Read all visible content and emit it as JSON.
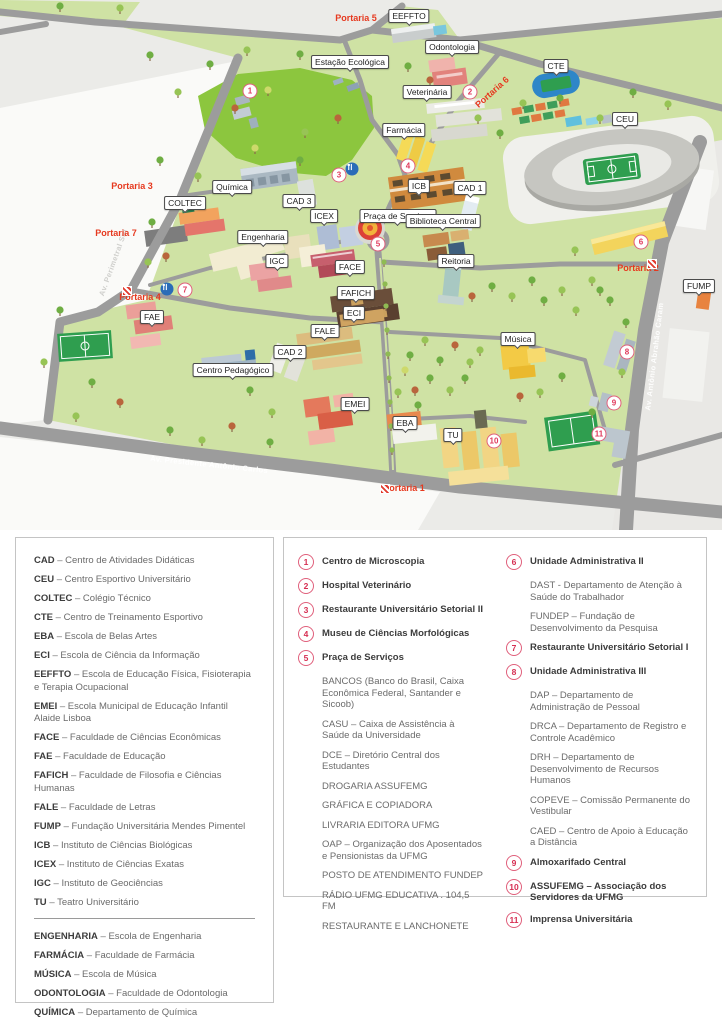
{
  "colors": {
    "campus_green": "#cfe2a4",
    "forest_green": "#8cc63e",
    "road_gray": "#9c9c9c",
    "portaria_red": "#e6391f",
    "marker_pink": "#e23a5f"
  },
  "map": {
    "labels": [
      "EEFFTO",
      "Odontologia",
      "Estação Ecológica",
      "CTE",
      "Veterinária",
      "CEU",
      "Farmácia",
      "Química",
      "ICB",
      "CAD 1",
      "COLTEC",
      "CAD 3",
      "ICEX",
      "Praça de Serviços",
      "Biblioteca Central",
      "Engenharia",
      "IGC",
      "Reitoria",
      "FACE",
      "FUMP",
      "FAFICH",
      "FAE",
      "ECI",
      "FALE",
      "Música",
      "CAD 2",
      "Centro Pedagógico",
      "EMEI",
      "EBA",
      "TU"
    ],
    "portarias": [
      "Portaria 5",
      "Portaria 6",
      "Portaria 3",
      "Portaria 7",
      "Portaria 4",
      "Portaria 2",
      "Portaria 1"
    ],
    "streets": [
      "Av. Perimetral Sul",
      "Av. Presidente Antônio Carlos",
      "Av. Antônio Abrahão Caram"
    ],
    "markers": [
      "1",
      "2",
      "3",
      "4",
      "5",
      "6",
      "7",
      "8",
      "9",
      "10",
      "11"
    ]
  },
  "legend_abbr": {
    "items": [
      {
        "abbr": "CAD",
        "desc": "– Centro de Atividades Didáticas"
      },
      {
        "abbr": "CEU",
        "desc": "– Centro Esportivo Universitário"
      },
      {
        "abbr": "COLTEC",
        "desc": "– Colégio Técnico"
      },
      {
        "abbr": "CTE",
        "desc": "– Centro de Treinamento Esportivo"
      },
      {
        "abbr": "EBA",
        "desc": "– Escola de Belas Artes"
      },
      {
        "abbr": "ECI",
        "desc": "– Escola de Ciência da Informação"
      },
      {
        "abbr": "EEFFTO",
        "desc": "– Escola de Educação Física, Fisioterapia e Terapia Ocupacional"
      },
      {
        "abbr": "EMEI",
        "desc": "– Escola Municipal de Educação Infantil Alaide Lisboa"
      },
      {
        "abbr": "FACE",
        "desc": "– Faculdade de Ciências Econômicas"
      },
      {
        "abbr": "FAE",
        "desc": "– Faculdade de Educação"
      },
      {
        "abbr": "FAFICH",
        "desc": "– Faculdade de Filosofia e Ciências Humanas"
      },
      {
        "abbr": "FALE",
        "desc": "– Faculdade de Letras"
      },
      {
        "abbr": "FUMP",
        "desc": "– Fundação Universitária Mendes Pimentel"
      },
      {
        "abbr": "ICB",
        "desc": "– Instituto de Ciências Biológicas"
      },
      {
        "abbr": "ICEX",
        "desc": "– Instituto de Ciências Exatas"
      },
      {
        "abbr": "IGC",
        "desc": "– Instituto de Geociências"
      },
      {
        "abbr": "TU",
        "desc": "– Teatro Universitário"
      }
    ],
    "items2": [
      {
        "abbr": "ENGENHARIA",
        "desc": "– Escola de Engenharia"
      },
      {
        "abbr": "FARMÁCIA",
        "desc": "– Faculdade de Farmácia"
      },
      {
        "abbr": "MÚSICA",
        "desc": "– Escola de Música"
      },
      {
        "abbr": "ODONTOLOGIA",
        "desc": "– Faculdade de Odontologia"
      },
      {
        "abbr": "QUÍMICA",
        "desc": "– Departamento de Química"
      },
      {
        "abbr": "VETERINÁRIA",
        "desc": "– Escola de Veterinária"
      }
    ]
  },
  "legend_numbered": {
    "left": [
      {
        "num": "1",
        "title": "Centro de Microscopia",
        "subs": []
      },
      {
        "num": "2",
        "title": "Hospital Veterinário",
        "subs": []
      },
      {
        "num": "3",
        "title": "Restaurante Universitário Setorial II",
        "subs": []
      },
      {
        "num": "4",
        "title": "Museu de Ciências Morfológicas",
        "subs": []
      },
      {
        "num": "5",
        "title": "Praça de Serviços",
        "subs": [
          "BANCOS (Banco do Brasil, Caixa Econômica Federal, Santander e Sicoob)",
          "CASU – Caixa de Assistência à Saúde da Universidade",
          "DCE – Diretório Central dos Estudantes",
          "DROGARIA ASSUFEMG",
          "GRÁFICA E COPIADORA",
          "LIVRARIA EDITORA UFMG",
          "OAP – Organização dos Aposentados e Pensionistas da UFMG",
          "POSTO DE ATENDIMENTO FUNDEP",
          "RÁDIO UFMG EDUCATIVA . 104,5 FM",
          "RESTAURANTE E LANCHONETE"
        ]
      }
    ],
    "right": [
      {
        "num": "6",
        "title": "Unidade Administrativa II",
        "subs": [
          "DAST - Departamento de Atenção à Saúde do Trabalhador",
          "FUNDEP – Fundação de Desenvolvimento da Pesquisa"
        ]
      },
      {
        "num": "7",
        "title": "Restaurante Universitário Setorial I",
        "subs": []
      },
      {
        "num": "8",
        "title": "Unidade Administrativa III",
        "subs": [
          "DAP – Departamento de Administração de Pessoal",
          "DRCA – Departamento de Registro e Controle Acadêmico",
          "DRH – Departamento de Desenvolvimento de Recursos Humanos",
          "COPEVE – Comissão Permanente do Vestibular",
          "CAED – Centro de Apoio à Educação a Distância"
        ]
      },
      {
        "num": "9",
        "title": "Almoxarifado Central",
        "subs": []
      },
      {
        "num": "10",
        "title": "ASSUFEMG – Associação dos Servidores da UFMG",
        "subs": []
      },
      {
        "num": "11",
        "title": "Imprensa Universitária",
        "subs": []
      }
    ]
  }
}
